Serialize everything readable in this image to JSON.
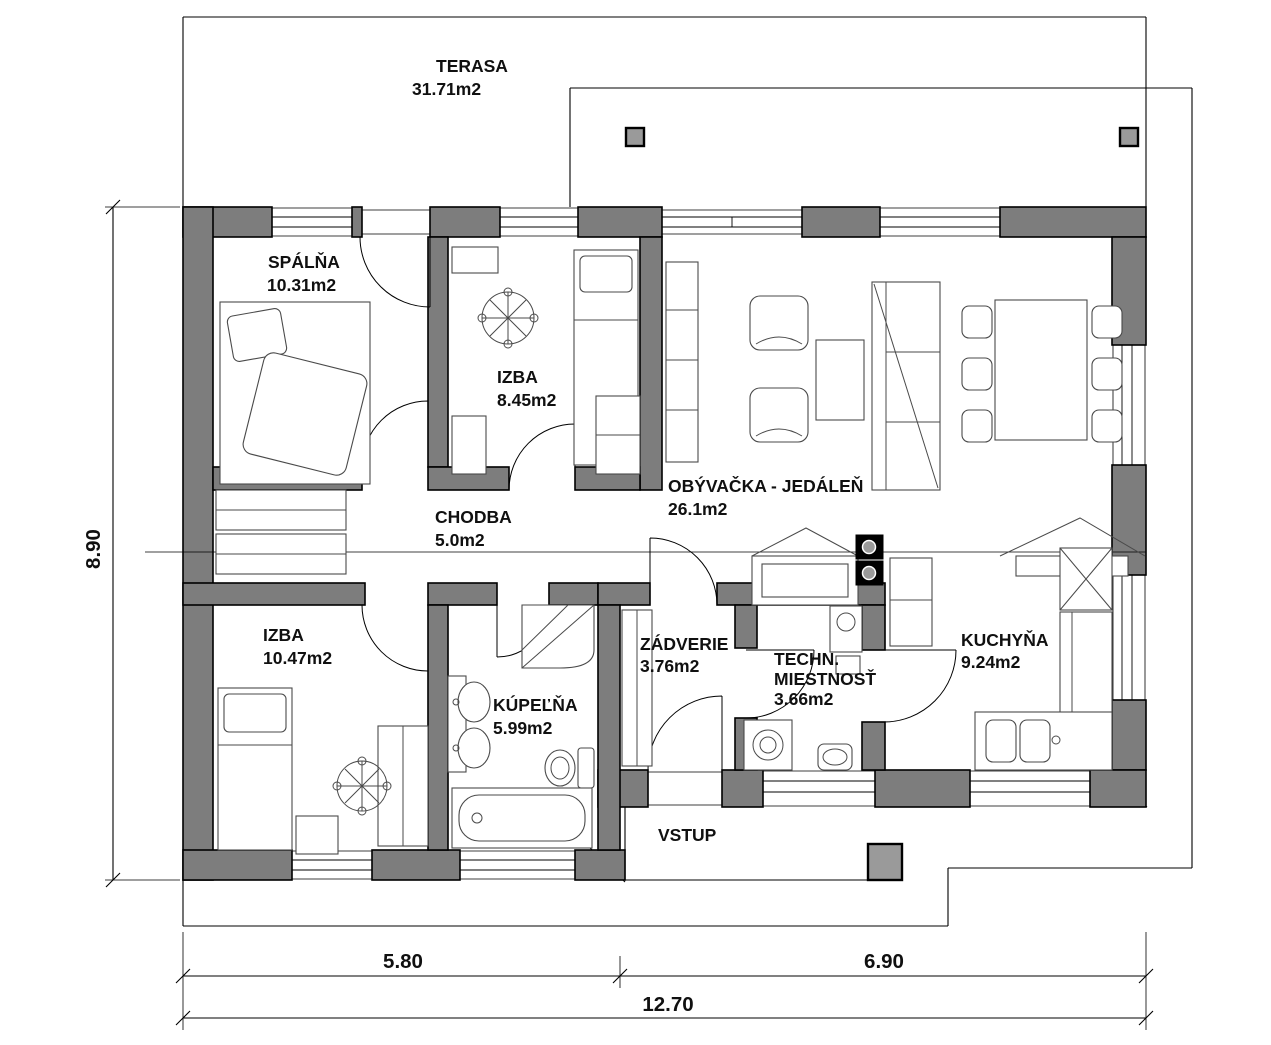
{
  "plan": {
    "rooms": {
      "terasa": {
        "name": "TERASA",
        "area": "31.71m2"
      },
      "spalna": {
        "name": "SPÁLŇA",
        "area": "10.31m2"
      },
      "izba1": {
        "name": "IZBA",
        "area": "8.45m2"
      },
      "obyvacka": {
        "name": "OBÝVAČKA - JEDÁLEŇ",
        "area": "26.1m2"
      },
      "chodba": {
        "name": "CHODBA",
        "area": "5.0m2"
      },
      "izba2": {
        "name": "IZBA",
        "area": "10.47m2"
      },
      "kupelna": {
        "name": "KÚPEĽŇA",
        "area": "5.99m2"
      },
      "zadverie": {
        "name": "ZÁDVERIE",
        "area": "3.76m2"
      },
      "techn": {
        "line1": "TECHN.",
        "line2": "MIESTNOSŤ",
        "area": "3.66m2"
      },
      "kuchyna": {
        "name": "KUCHYŇA",
        "area": "9.24m2"
      },
      "vstup": {
        "name": "VSTUP"
      }
    },
    "dimensions": {
      "height": "8.90",
      "bottom_left": "5.80",
      "bottom_right": "6.90",
      "total": "12.70"
    },
    "colors": {
      "wall": "#7d7d7d",
      "outline": "#000000",
      "furniture": "#4a4a4a",
      "background": "#ffffff"
    }
  }
}
